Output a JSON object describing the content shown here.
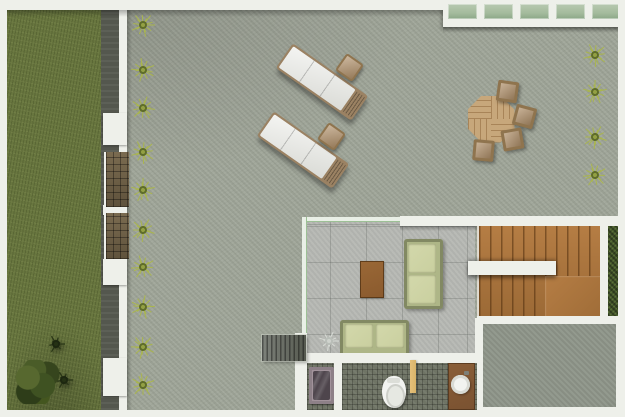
{
  "scene_type": "rooftop-terrace-floor-plan-render",
  "palette": {
    "wall": "#eef0ea",
    "grass": "#68763f",
    "walkway": "#54574e",
    "terrace": "#a1a79a",
    "terrace_lower": "#8f968a",
    "room_floor": "#b6b8b3",
    "glass_green": "#a4bb9d",
    "plant": "#aab64e",
    "plant_core": "#5e6c2a",
    "hedge": "#44582c",
    "stair_wood": "#ad763f",
    "rug_wood": "#8a5a2e",
    "sofa_frame": "#aeb687",
    "sofa_cushion": "#c9cf9f",
    "lounger_cushion": "#e8e9e4",
    "lounger_frame": "#9b8263",
    "table_wood": "#c7a77b",
    "chair_wood": "#b0906a",
    "mosaic": "#6f7465",
    "tub_outer": "#a2939b",
    "tub_inner": "#4e454c",
    "vanity_wood": "#7a5231",
    "door_tan": "#d9b469",
    "steps_gray": "#6a6e66",
    "fixture_white": "#f2f3f0"
  },
  "plants_left": {
    "x": 143,
    "ys": [
      25,
      70,
      108,
      152,
      190,
      230,
      267,
      307,
      347,
      385
    ]
  },
  "plants_right": {
    "x": 595,
    "ys": [
      55,
      92,
      137,
      175
    ]
  },
  "trees": [
    {
      "cx": 56,
      "cy": 344
    },
    {
      "cx": 64,
      "cy": 380
    }
  ],
  "room_plant": {
    "cx": 329,
    "cy": 341
  },
  "loungers": [
    {
      "cx": 322,
      "cy": 82,
      "angle": 35
    },
    {
      "cx": 303,
      "cy": 150,
      "angle": 35
    }
  ],
  "side_tables": [
    {
      "cx": 349,
      "cy": 67,
      "angle": 35
    },
    {
      "cx": 331,
      "cy": 136,
      "angle": 35
    }
  ],
  "dining": {
    "table": {
      "cx": 491,
      "cy": 119,
      "size": 47
    },
    "chairs": [
      {
        "cx": 507,
        "cy": 91,
        "angle": 8
      },
      {
        "cx": 524,
        "cy": 116,
        "angle": 15
      },
      {
        "cx": 512,
        "cy": 139,
        "angle": -10
      },
      {
        "cx": 483,
        "cy": 150,
        "angle": 5
      }
    ]
  },
  "skylight": {
    "panel_count": 5,
    "panel_width": 29,
    "panel_gap": 7
  },
  "wall_nubs": [
    {
      "y": 113,
      "h": 32
    },
    {
      "y": 205,
      "h": 10
    },
    {
      "y": 259,
      "h": 26
    },
    {
      "y": 358,
      "h": 38
    }
  ],
  "mats": [
    {
      "y": 152,
      "h": 55
    },
    {
      "y": 213,
      "h": 46
    }
  ]
}
